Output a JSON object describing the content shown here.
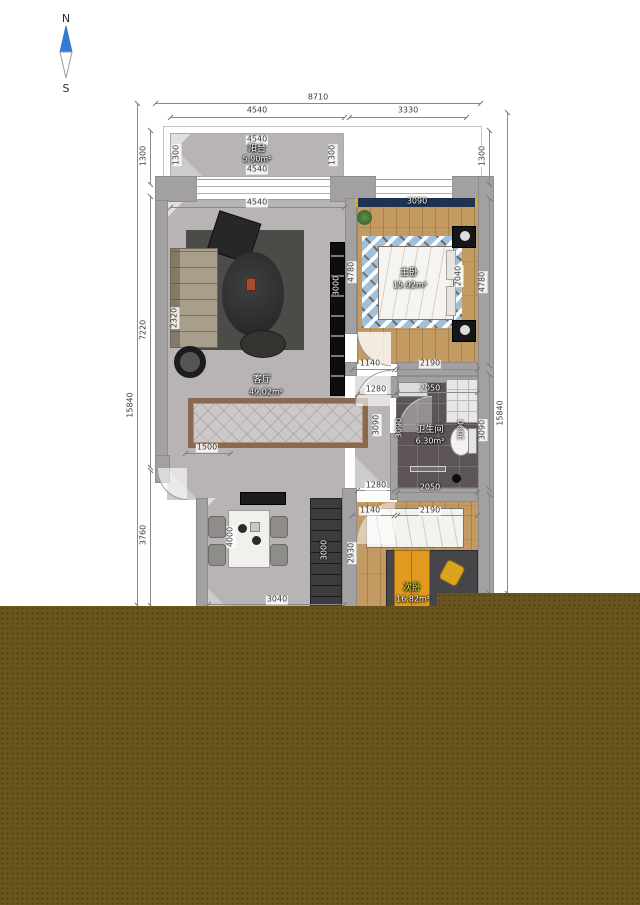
{
  "meta": {
    "type": "apartment floor plan"
  },
  "compass": {
    "north_label": "N",
    "south_label": "S"
  },
  "colors": {
    "wall_gray": "#a2a0a0",
    "marble_floor": "#cbc7c8",
    "wood_floor": "#c29a62",
    "bath_tile": "#5c5456",
    "curtain_navy": "#1d3350",
    "wardrobe_orange": "#e09a1e",
    "compass_blue": "#2f7bd6",
    "overlay_olive": "#6b551f",
    "rug_blue": "#9fc0d8"
  },
  "rooms": {
    "balcony": {
      "name": "阳台",
      "area": "5.90m²"
    },
    "living": {
      "name": "客厅",
      "area": "49.02m²"
    },
    "master": {
      "name": "主卧",
      "area": "15.92m²"
    },
    "bathroom": {
      "name": "卫生间",
      "area": "6.30m²"
    },
    "second": {
      "name": "次卧",
      "area": "16.82m²"
    }
  },
  "dims": {
    "overall_width": "8710",
    "top_left_span": "4540",
    "top_right_span": "3330",
    "balcony_top": "4540",
    "balcony_bottom": "4540",
    "balcony_left": "1300",
    "balcony_right": "1300",
    "living_top": "4540",
    "master_window": "3090",
    "left_1300": "1300",
    "left_7220": "7220",
    "left_3760": "3760",
    "left_overall": "15840",
    "right_1300": "1300",
    "right_4780": "4780",
    "right_3090": "3090",
    "right_overall": "15840",
    "sofa_depth": "2320",
    "tv_wall": "3000",
    "master_depth": "4780",
    "bed_width": "2040",
    "master_door": "1140",
    "master_wall": "2190",
    "hall_top": "1280",
    "bath_top": "2050",
    "hall_height": "3090",
    "bath_left": "3090",
    "bath_right": "3090",
    "living_niche": "1500",
    "hall_bottom": "1280",
    "bath_bottom": "2050",
    "second_door": "1140",
    "second_wall": "2190",
    "second_left": "2930",
    "dining_depth": "4000",
    "wardrobe_len": "3000",
    "bottom_width": "3040"
  }
}
